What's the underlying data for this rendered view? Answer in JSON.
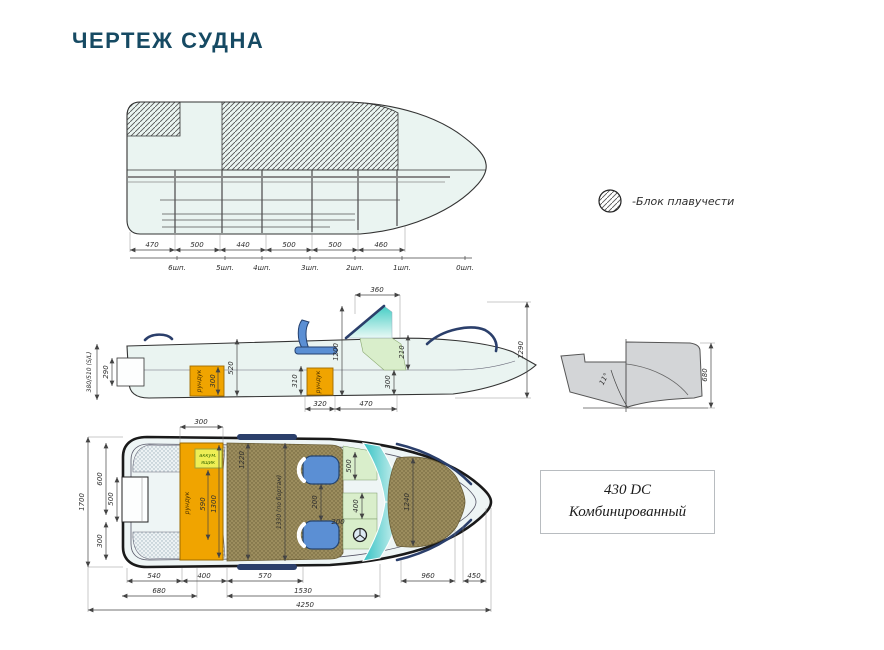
{
  "header": {
    "title": "ЧЕРТЕЖ СУДНА"
  },
  "legend": {
    "label": "-Блок плавучести"
  },
  "model_box": {
    "line1": "430 DC",
    "line2": "Комбинированный"
  },
  "top_view": {
    "dims": [
      "470",
      "500",
      "440",
      "500",
      "500",
      "460"
    ],
    "frames": [
      "6шп.",
      "5шп.",
      "4шп.",
      "3шп.",
      "2шп.",
      "1шп.",
      "0шп."
    ]
  },
  "side_view": {
    "transom_height": "380/510 (S/L)",
    "dim_290": "290",
    "locker1_label": "рундук",
    "locker1_height": "300",
    "dim_520": "520",
    "dim_310": "310",
    "locker2_label": "рундук",
    "dim_1200": "1200",
    "dim_360": "360",
    "dim_210": "210",
    "dim_300": "300",
    "dim_320": "320",
    "dim_470": "470",
    "dim_1290": "1290"
  },
  "transom_view": {
    "deadrise_angle": "11°",
    "dim_680": "680"
  },
  "plan_view": {
    "dim_300_top": "300",
    "dim_1700": "1700",
    "dim_600": "600",
    "dim_500_motorwell": "500",
    "dim_300_left": "300",
    "battery_label_1": "аккум.",
    "battery_label_2": "ящик",
    "locker_label": "рундук",
    "dim_590": "590",
    "dim_1300": "1300",
    "dim_1220": "1220",
    "dim_1330": "1330 (по бортам)",
    "dim_500_seat": "500",
    "dim_200_seats": "200",
    "dim_400": "400",
    "dim_200_helm": "200",
    "dim_1240": "1240",
    "bottom_row1": [
      "540",
      "400",
      "570",
      "960",
      "450"
    ],
    "bottom_row2": [
      "680",
      "1530"
    ],
    "bottom_row3": [
      "4250"
    ]
  }
}
